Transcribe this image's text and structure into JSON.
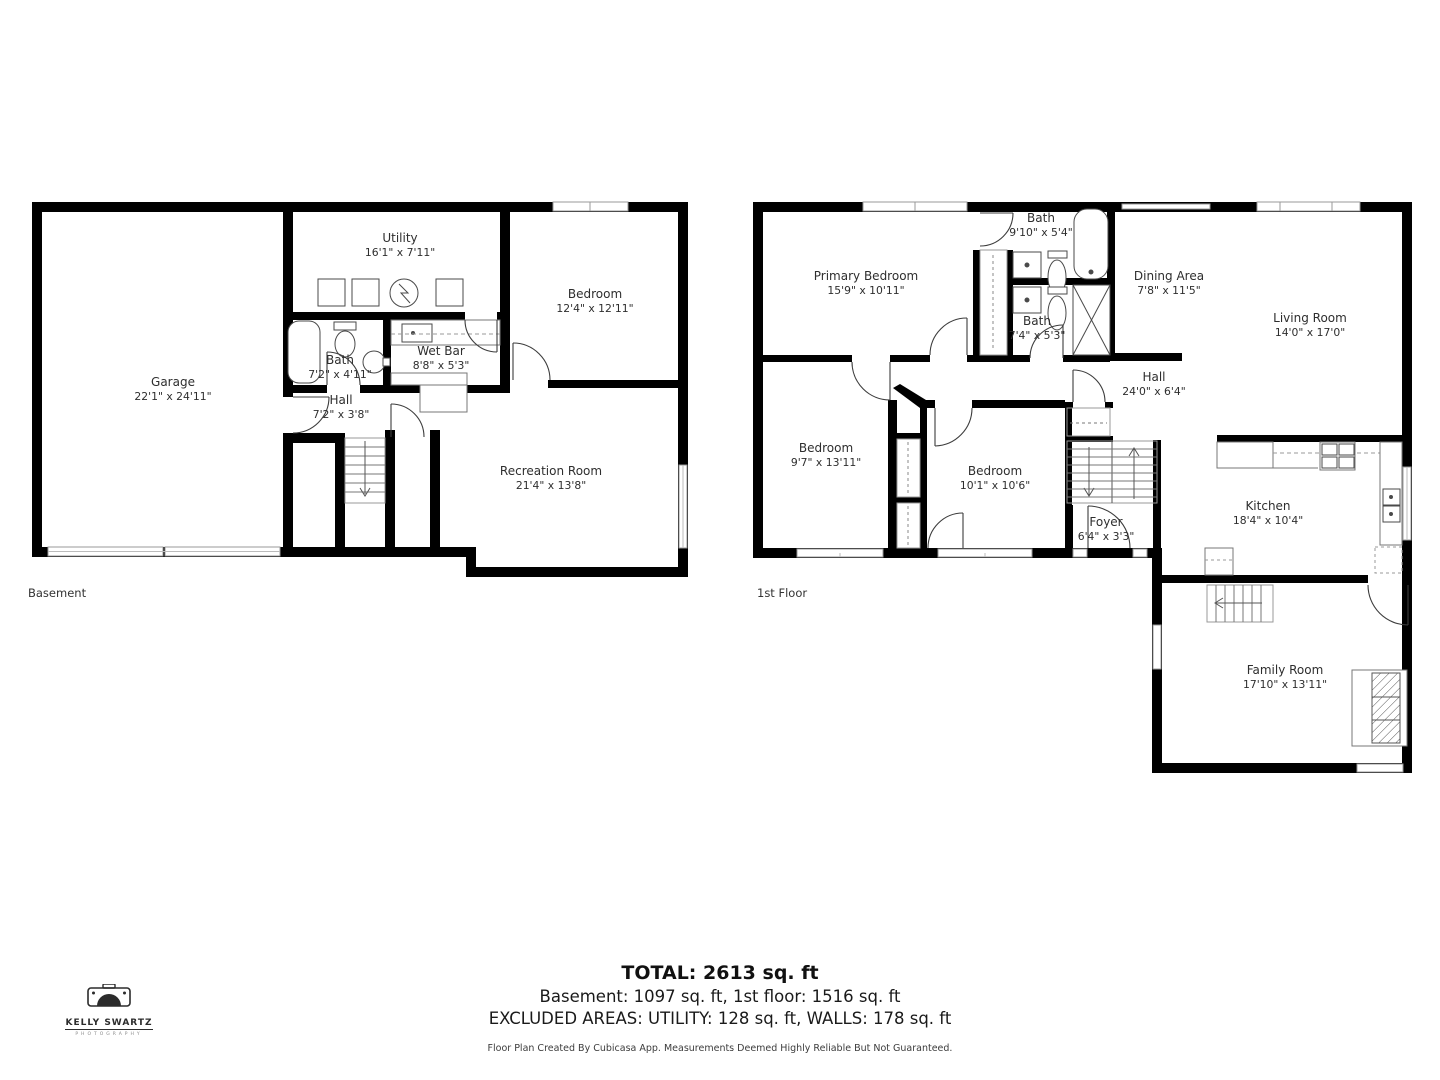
{
  "basement": {
    "floor_label": "Basement",
    "rooms": [
      {
        "name": "Garage",
        "dims": "22'1\" x 24'11\""
      },
      {
        "name": "Utility",
        "dims": "16'1\" x 7'11\""
      },
      {
        "name": "Bedroom",
        "dims": "12'4\" x 12'11\""
      },
      {
        "name": "Bath",
        "dims": "7'2\" x 4'11\""
      },
      {
        "name": "Wet Bar",
        "dims": "8'8\" x 5'3\""
      },
      {
        "name": "Hall",
        "dims": "7'2\" x 3'8\""
      },
      {
        "name": "Recreation Room",
        "dims": "21'4\" x 13'8\""
      }
    ]
  },
  "first_floor": {
    "floor_label": "1st Floor",
    "rooms": [
      {
        "name": "Primary Bedroom",
        "dims": "15'9\" x 10'11\""
      },
      {
        "name": "Bath",
        "dims": "9'10\" x 5'4\""
      },
      {
        "name": "Dining Area",
        "dims": "7'8\" x 11'5\""
      },
      {
        "name": "Living Room",
        "dims": "14'0\" x 17'0\""
      },
      {
        "name": "Bath",
        "dims": "7'4\" x 5'3\""
      },
      {
        "name": "Hall",
        "dims": "24'0\" x 6'4\""
      },
      {
        "name": "Bedroom",
        "dims": "9'7\" x 13'11\""
      },
      {
        "name": "Bedroom",
        "dims": "10'1\" x 10'6\""
      },
      {
        "name": "Foyer",
        "dims": "6'4\" x 3'3\""
      },
      {
        "name": "Kitchen",
        "dims": "18'4\" x 10'4\""
      },
      {
        "name": "Family Room",
        "dims": "17'10\" x 13'11\""
      }
    ]
  },
  "summary": {
    "total": "TOTAL: 2613 sq. ft",
    "floors": "Basement: 1097 sq. ft, 1st floor: 1516 sq. ft",
    "excluded": "EXCLUDED AREAS: UTILITY: 128 sq. ft, WALLS: 178 sq. ft",
    "disclaimer": "Floor Plan Created By Cubicasa App. Measurements Deemed Highly Reliable But Not Guaranteed."
  },
  "logo": {
    "title": "KELLY SWARTZ",
    "subtitle": "PHOTOGRAPHY",
    "icon": "camera-icon"
  },
  "colors": {
    "wall": "#000000",
    "fixture_stroke": "#4a4a4a",
    "window_stroke": "#999999",
    "text": "#2e2e2e"
  }
}
